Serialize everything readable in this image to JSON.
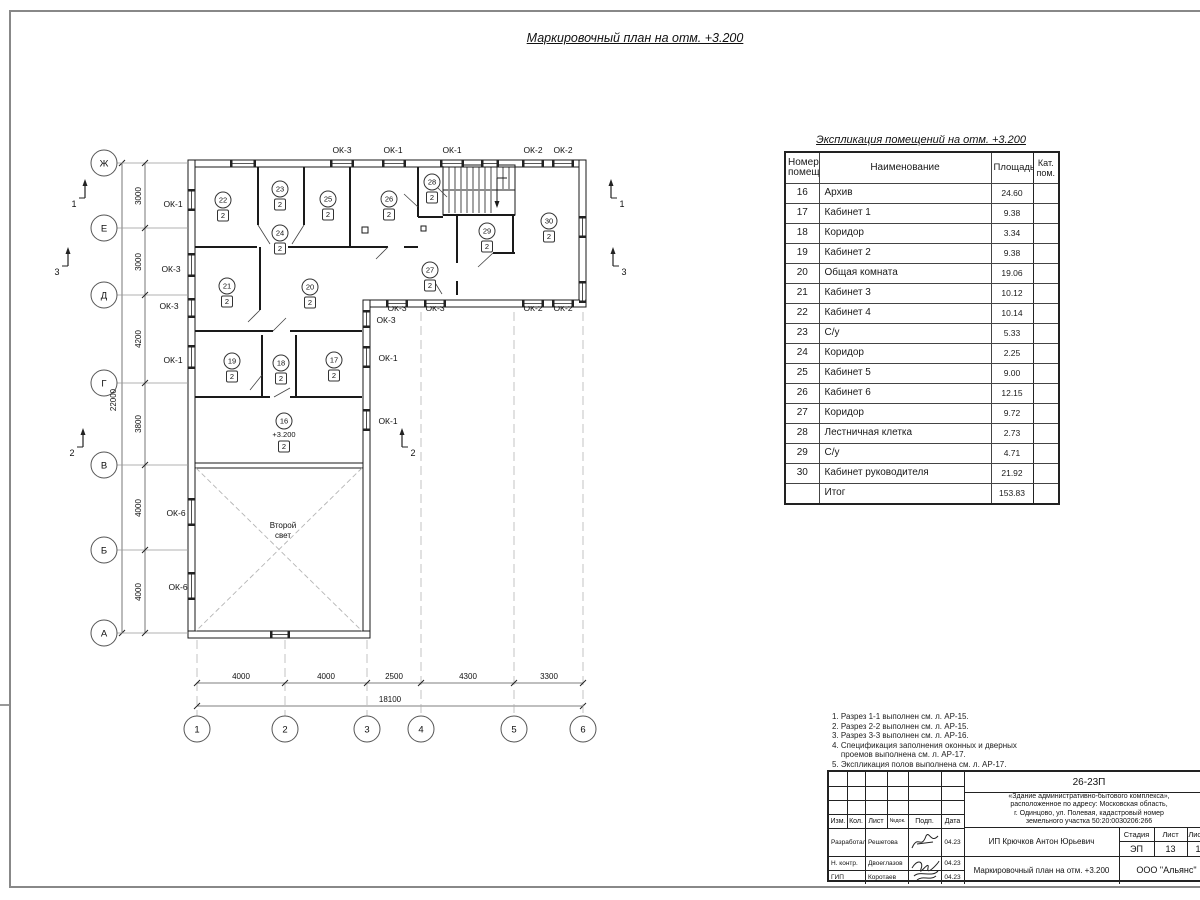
{
  "page": {
    "title": "Маркировочный план на отм. +3.200"
  },
  "plan": {
    "grid_rows": [
      {
        "label": "Ж",
        "y": 163
      },
      {
        "label": "Е",
        "y": 228
      },
      {
        "label": "Д",
        "y": 295
      },
      {
        "label": "Г",
        "y": 383
      },
      {
        "label": "В",
        "y": 465
      },
      {
        "label": "Б",
        "y": 550
      },
      {
        "label": "А",
        "y": 633
      }
    ],
    "grid_cols": [
      {
        "label": "1",
        "x": 197
      },
      {
        "label": "2",
        "x": 285
      },
      {
        "label": "3",
        "x": 367
      },
      {
        "label": "4",
        "x": 421
      },
      {
        "label": "5",
        "x": 514
      },
      {
        "label": "6",
        "x": 583
      }
    ],
    "dims_left": [
      {
        "text": "3000",
        "y": 196
      },
      {
        "text": "3000",
        "y": 262
      },
      {
        "text": "4200",
        "y": 339
      },
      {
        "text": "3800",
        "y": 424
      },
      {
        "text": "4000",
        "y": 508
      },
      {
        "text": "4000",
        "y": 592
      }
    ],
    "dim_left_total": "22000",
    "dims_bottom": [
      {
        "text": "4000",
        "x": 241
      },
      {
        "text": "4000",
        "x": 326
      },
      {
        "text": "2500",
        "x": 394
      },
      {
        "text": "4300",
        "x": 468
      },
      {
        "text": "3300",
        "x": 549
      }
    ],
    "dim_bottom_total": "18100",
    "window_labels": [
      {
        "label": "ОК-3",
        "x": 342,
        "y": 153
      },
      {
        "label": "ОК-1",
        "x": 393,
        "y": 153
      },
      {
        "label": "ОК-1",
        "x": 452,
        "y": 153
      },
      {
        "label": "ОК-2",
        "x": 533,
        "y": 153
      },
      {
        "label": "ОК-2",
        "x": 563,
        "y": 153
      },
      {
        "label": "ОК-1",
        "x": 173,
        "y": 207
      },
      {
        "label": "ОК-3",
        "x": 171,
        "y": 272
      },
      {
        "label": "ОК-3",
        "x": 169,
        "y": 309
      },
      {
        "label": "ОК-1",
        "x": 173,
        "y": 363
      },
      {
        "label": "ОК-6",
        "x": 176,
        "y": 516
      },
      {
        "label": "ОК-6",
        "x": 178,
        "y": 590
      },
      {
        "label": "ОК-3",
        "x": 397,
        "y": 311
      },
      {
        "label": "ОК-3",
        "x": 435,
        "y": 311
      },
      {
        "label": "ОК-2",
        "x": 533,
        "y": 311
      },
      {
        "label": "ОК-2",
        "x": 563,
        "y": 311
      },
      {
        "label": "ОК-3",
        "x": 386,
        "y": 323
      },
      {
        "label": "ОК-1",
        "x": 388,
        "y": 361
      },
      {
        "label": "ОК-1",
        "x": 388,
        "y": 424
      }
    ],
    "rooms": [
      {
        "num": "22",
        "cat": "2",
        "x": 223,
        "y": 200
      },
      {
        "num": "23",
        "cat": "2",
        "x": 280,
        "y": 189
      },
      {
        "num": "25",
        "cat": "2",
        "x": 328,
        "y": 199
      },
      {
        "num": "24",
        "cat": "2",
        "x": 280,
        "y": 233
      },
      {
        "num": "26",
        "cat": "2",
        "x": 389,
        "y": 199
      },
      {
        "num": "28",
        "cat": "2",
        "x": 432,
        "y": 182
      },
      {
        "num": "29",
        "cat": "2",
        "x": 487,
        "y": 231
      },
      {
        "num": "30",
        "cat": "2",
        "x": 549,
        "y": 221
      },
      {
        "num": "27",
        "cat": "2",
        "x": 430,
        "y": 270
      },
      {
        "num": "21",
        "cat": "2",
        "x": 227,
        "y": 286
      },
      {
        "num": "20",
        "cat": "2",
        "x": 310,
        "y": 287
      },
      {
        "num": "19",
        "cat": "2",
        "x": 232,
        "y": 361
      },
      {
        "num": "18",
        "cat": "2",
        "x": 281,
        "y": 363
      },
      {
        "num": "17",
        "cat": "2",
        "x": 334,
        "y": 360
      },
      {
        "num": "16",
        "cat": "2",
        "x": 284,
        "y": 421,
        "level": "+3.200"
      }
    ],
    "sections": [
      {
        "label": "1",
        "tx": 74,
        "ty": 207,
        "ax": 85,
        "ay": 198
      },
      {
        "label": "3",
        "tx": 57,
        "ty": 275,
        "ax": 68,
        "ay": 266
      },
      {
        "label": "2",
        "tx": 72,
        "ty": 456,
        "ax": 83,
        "ay": 447
      },
      {
        "label": "1",
        "tx": 622,
        "ty": 207,
        "ax": 611,
        "ay": 198
      },
      {
        "label": "3",
        "tx": 624,
        "ty": 275,
        "ax": 613,
        "ay": 266
      },
      {
        "label": "2",
        "tx": 413,
        "ty": 456,
        "ax": 402,
        "ay": 447
      }
    ],
    "second_light": {
      "line1": "Второй",
      "line2": "свет"
    }
  },
  "table": {
    "title": "Экспликация помещений на отм. +3.200",
    "headers": {
      "num": "Номер\nпомещ.",
      "name": "Наименование",
      "area": "Площадь",
      "cat": "Кат.\nпом."
    },
    "rows": [
      {
        "num": "16",
        "name": "Архив",
        "area": "24.60"
      },
      {
        "num": "17",
        "name": "Кабинет 1",
        "area": "9.38"
      },
      {
        "num": "18",
        "name": "Коридор",
        "area": "3.34"
      },
      {
        "num": "19",
        "name": "Кабинет 2",
        "area": "9.38"
      },
      {
        "num": "20",
        "name": "Общая комната",
        "area": "19.06"
      },
      {
        "num": "21",
        "name": "Кабинет 3",
        "area": "10.12"
      },
      {
        "num": "22",
        "name": "Кабинет 4",
        "area": "10.14"
      },
      {
        "num": "23",
        "name": "С/у",
        "area": "5.33"
      },
      {
        "num": "24",
        "name": "Коридор",
        "area": "2.25"
      },
      {
        "num": "25",
        "name": "Кабинет 5",
        "area": "9.00"
      },
      {
        "num": "26",
        "name": "Кабинет 6",
        "area": "12.15"
      },
      {
        "num": "27",
        "name": "Коридор",
        "area": "9.72"
      },
      {
        "num": "28",
        "name": "Лестничная клетка",
        "area": "2.73"
      },
      {
        "num": "29",
        "name": "С/у",
        "area": "4.71"
      },
      {
        "num": "30",
        "name": "Кабинет руководителя",
        "area": "21.92"
      }
    ],
    "total_label": "Итог",
    "total": "153.83"
  },
  "notes": {
    "lines": [
      "1. Разрез 1-1 выполнен см. л. АР-15.",
      "2. Разрез 2-2 выполнен см. л. АР-15.",
      "3. Разрез 3-3 выполнен см. л. АР-16.",
      "4. Спецификация заполнения оконных и дверных",
      "    проемов выполнена см. л. АР-17.",
      "5. Экспликация полов выполнена см. л. АР-17."
    ]
  },
  "stamp": {
    "doc_number": "26-23П",
    "object_lines": [
      "«Здание административно-бытового комплекса»,",
      "расположенное по адресу: Московская область,",
      "г. Одинцово, ул. Полевая, кадастровый номер",
      "земельного участка 50:20:0030206:266"
    ],
    "cols": {
      "izm": "Изм.",
      "kol": "Кол.",
      "list": "Лист",
      "ndok": "№док.",
      "podp": "Подп.",
      "data": "Дата"
    },
    "rows": [
      {
        "role": "Разработал",
        "name": "Решетова",
        "date": "04.23"
      },
      {
        "role": "Н. контр.",
        "name": "Двоеглазов",
        "date": "04.23"
      },
      {
        "role": "ГИП",
        "name": "Коротаев",
        "date": "04.23"
      }
    ],
    "client": "ИП Крючков Антон Юрьевич",
    "stage_label": "Стадия",
    "sheet_label": "Лист",
    "sheets_label": "Листов",
    "stage": "ЭП",
    "sheet": "13",
    "sheets": "17",
    "sheet_title": "Маркировочный план на отм. +3.200",
    "company": "ООО \"Альянс\""
  }
}
